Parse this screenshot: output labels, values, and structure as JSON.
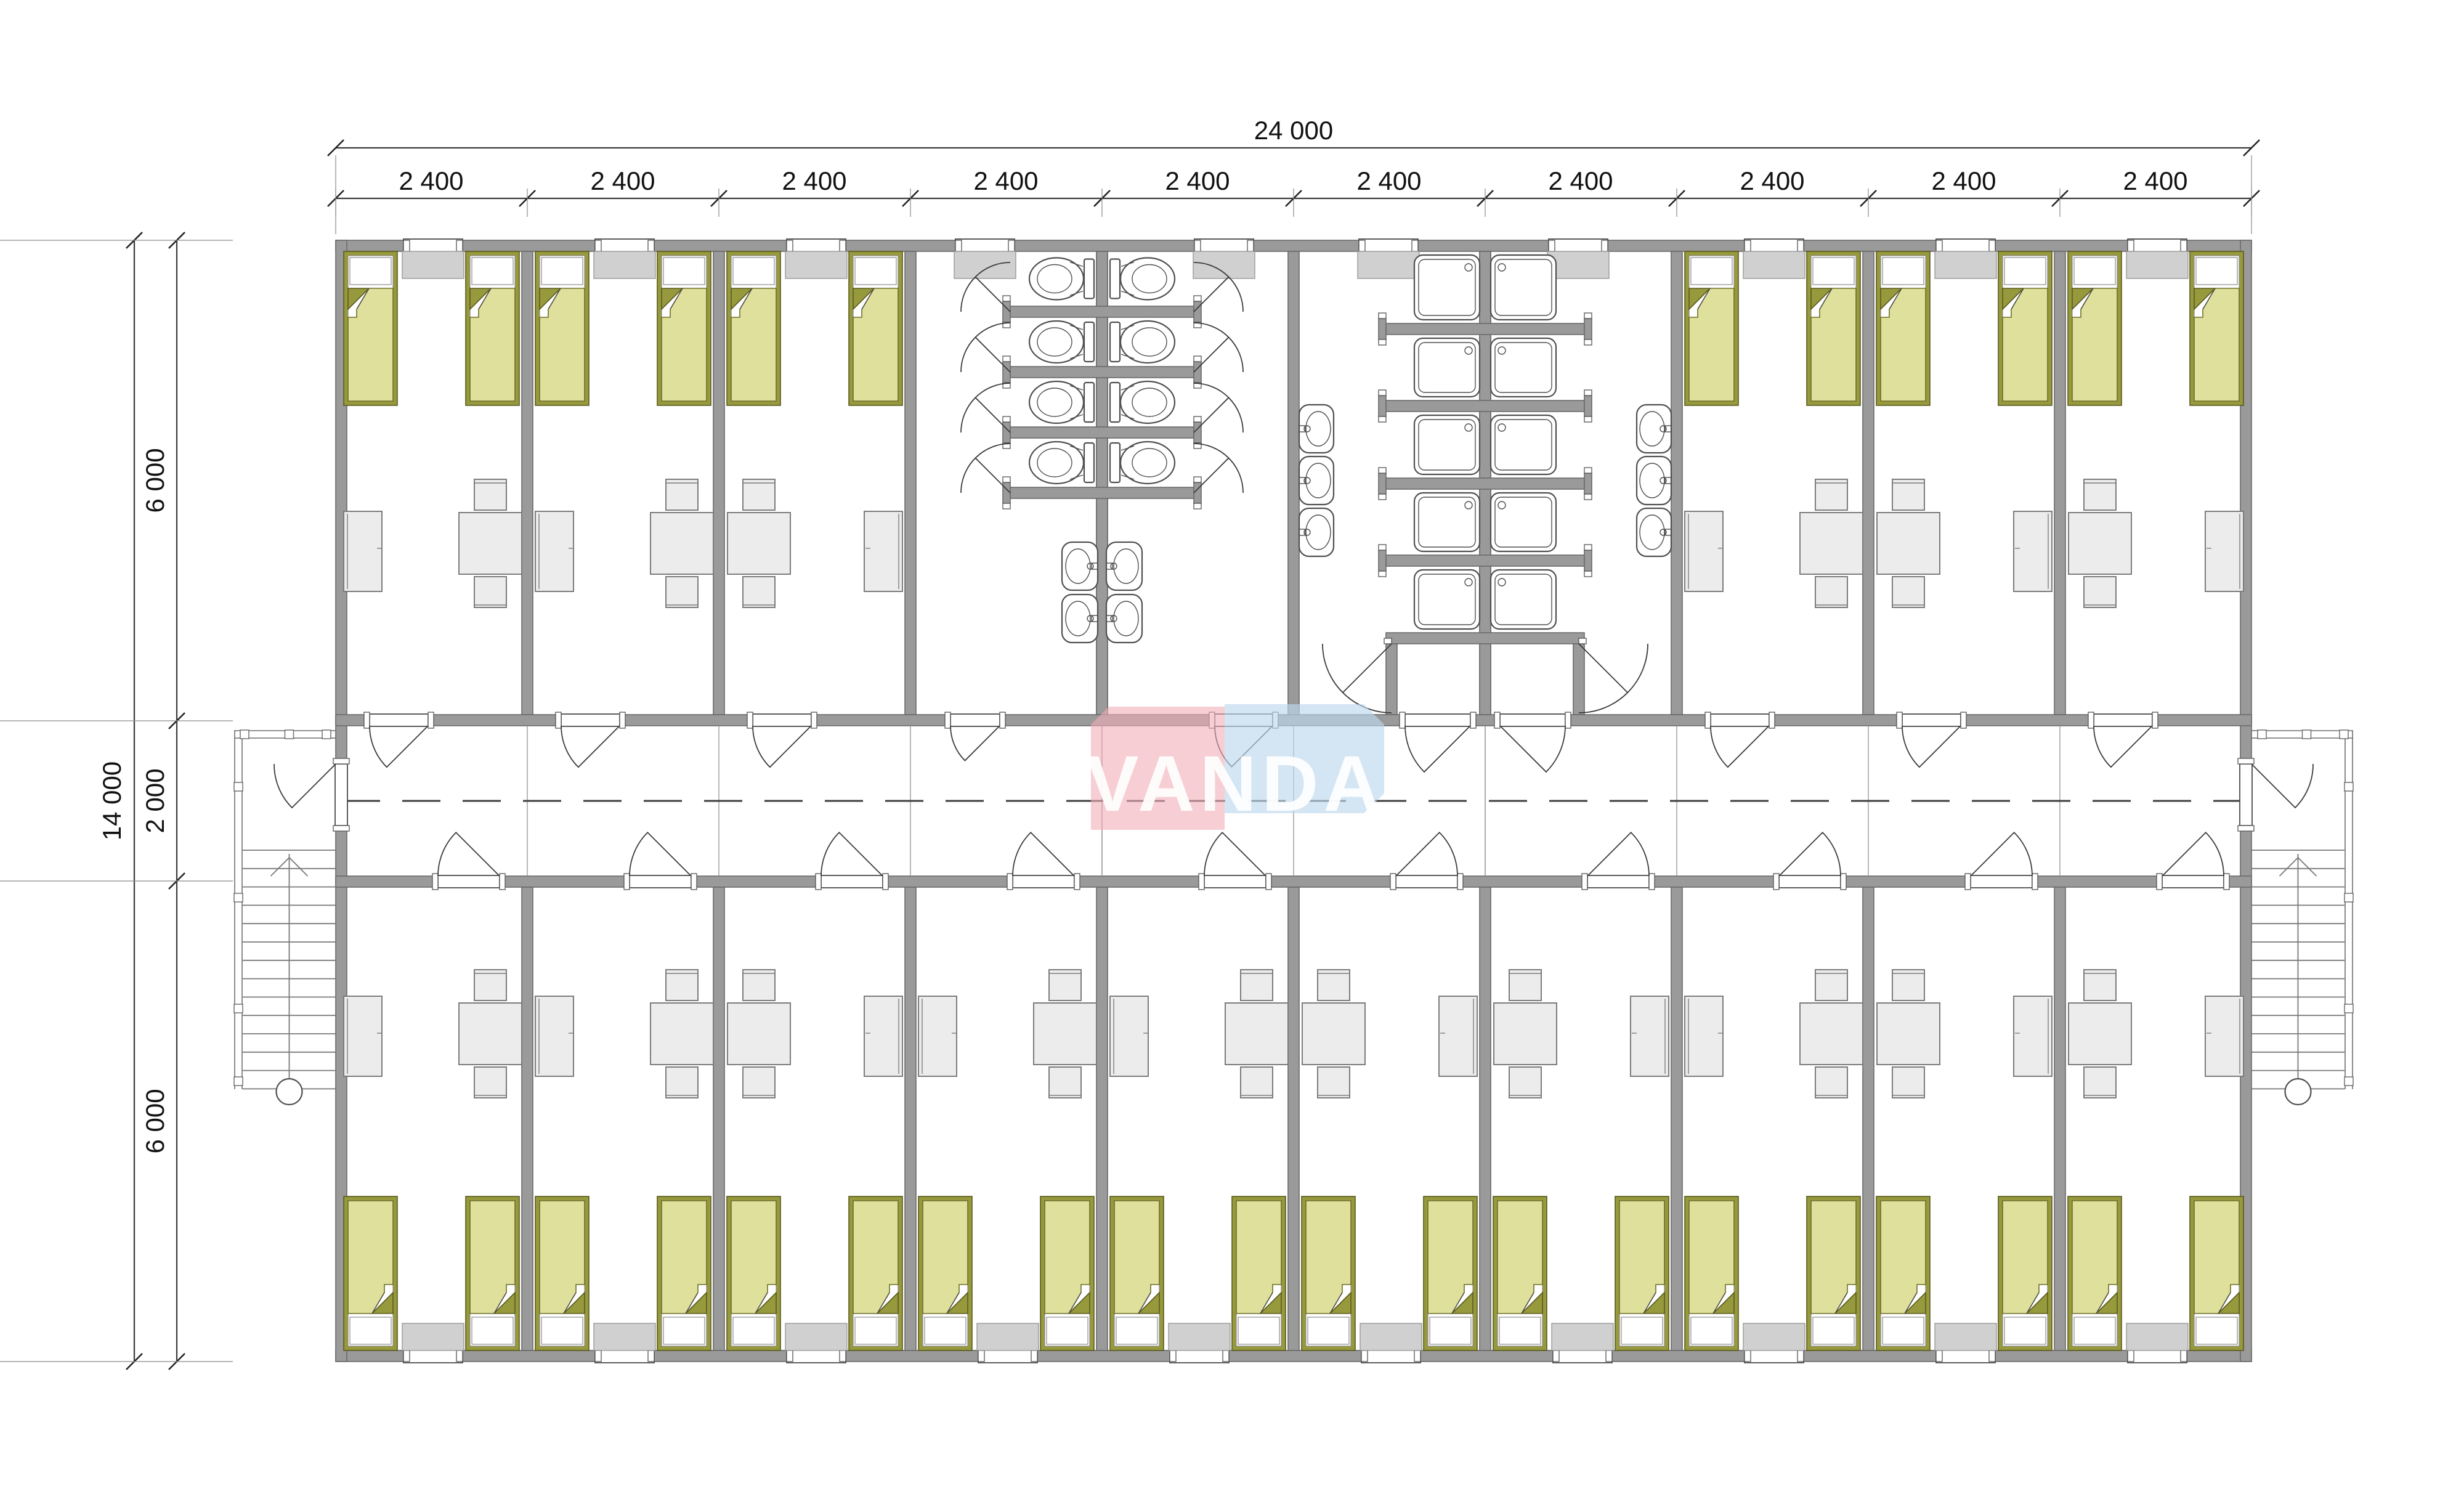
{
  "dimensions": {
    "top_total": "24 000",
    "top_segments": [
      "2 400",
      "2 400",
      "2 400",
      "2 400",
      "2 400",
      "2 400",
      "2 400",
      "2 400",
      "2 400",
      "2 400"
    ],
    "left_total": "14 000",
    "left_segments": [
      "6 000",
      "2 000",
      "6 000"
    ]
  },
  "watermark": {
    "text": "VANDA",
    "pink": "#f2aeb8",
    "blue": "#bdd7ec",
    "text_color": "#ffffff"
  },
  "colors": {
    "wall": "#9a9a9a",
    "bed_frame": "#97993d",
    "bed_blanket": "#dfe09c",
    "furniture": "#ececec",
    "window_sill": "#d0d0d0"
  },
  "plan_summary": {
    "modules": 10,
    "bedrooms": 16,
    "beds": 32,
    "tables": 16,
    "chairs": 32,
    "wardrobes": 16,
    "toilet_stalls": 8,
    "toilet_basins": 4,
    "shower_trays": 10,
    "shower_basins": 6,
    "staircases": 2
  }
}
